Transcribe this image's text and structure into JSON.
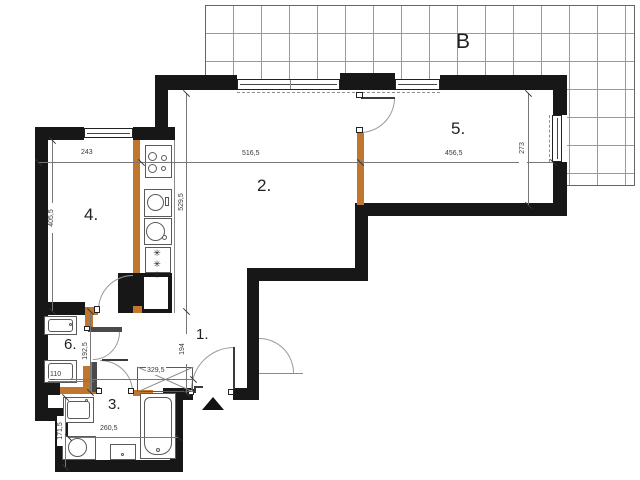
{
  "plan": {
    "balcony_label": "B",
    "rooms": {
      "r1": "1.",
      "r2": "2.",
      "r3": "3.",
      "r4": "4.",
      "r5": "5.",
      "r6": "6."
    },
    "dimensions": {
      "room4_width": "243",
      "room4_depth": "405,5",
      "kitchen_wall_run": "529,5",
      "living_width": "516,5",
      "room5_width": "456,5",
      "room5_window_height": "273",
      "hall_depth": "194",
      "wc_depth": "192,5",
      "wc_width": "110",
      "bath_depth": "171,5",
      "bath_width": "260,5",
      "hall_width": "329,5"
    },
    "symbols": {
      "fridge": "✳✳✳"
    },
    "colors": {
      "structural_wall": "#171717",
      "new_partition": "#c0762c",
      "light_partition": "#4a4a4a",
      "dimension_text": "#3a3a3a",
      "fixture_line": "#5a5a5a",
      "terrace_grid": "#9a9a9a",
      "door_arc": "#9b9b9b"
    }
  }
}
